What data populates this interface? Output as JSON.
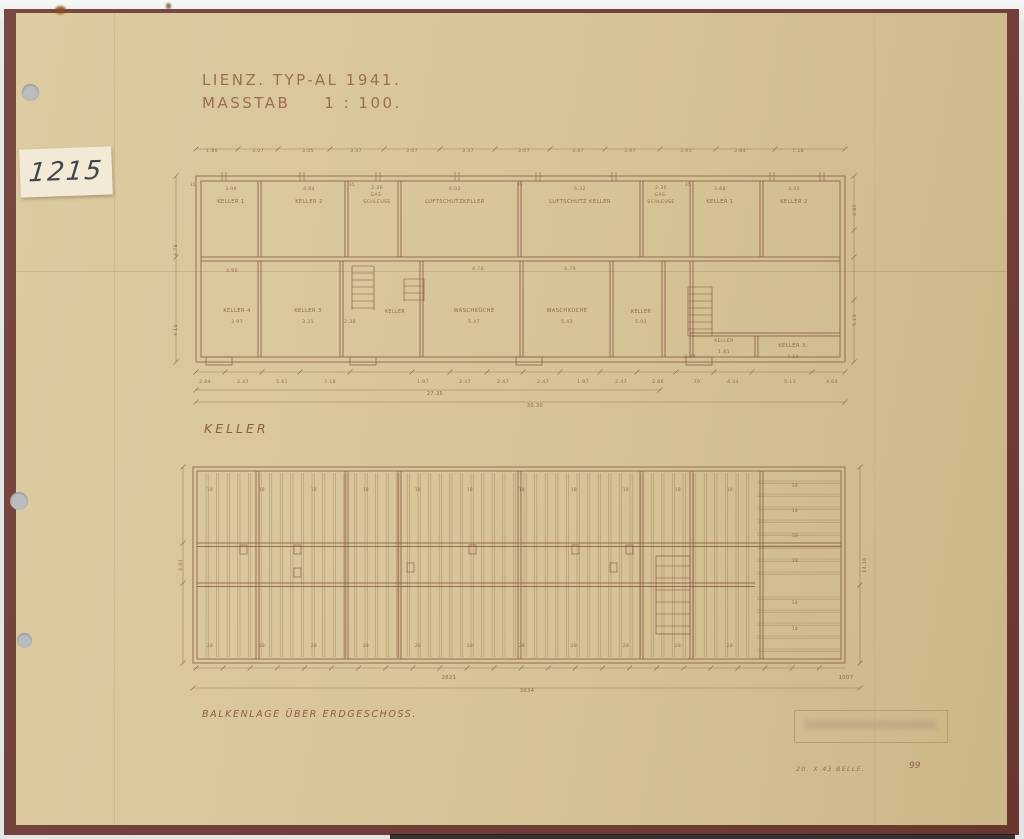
{
  "sheet": {
    "inventory_number": "1215",
    "title_line1": "LIENZ. TYP-AL 1941.",
    "scale_label": "MASSTAB",
    "scale_value": "1 : 100.",
    "plan1_caption": "KELLER",
    "plan2_caption": "BALKENLAGE ÜBER ERDGESCHOSS.",
    "footer_note": "20. X 43 BELLE.",
    "footer_number": "99"
  },
  "colors": {
    "paper": "#d7c498",
    "frame": "#74413c",
    "ink": "#8a5f49",
    "ink_light": "#a27b5e"
  },
  "drawing": {
    "texts": [
      {
        "x": 212,
        "y": 152,
        "t": "1.80"
      },
      {
        "x": 258,
        "y": 152,
        "t": "3.07"
      },
      {
        "x": 308,
        "y": 152,
        "t": "3.05"
      },
      {
        "x": 356,
        "y": 152,
        "t": "3.37"
      },
      {
        "x": 412,
        "y": 152,
        "t": "3.07"
      },
      {
        "x": 468,
        "y": 152,
        "t": "3.37"
      },
      {
        "x": 524,
        "y": 152,
        "t": "3.07"
      },
      {
        "x": 578,
        "y": 152,
        "t": "3.47"
      },
      {
        "x": 630,
        "y": 152,
        "t": "3.07"
      },
      {
        "x": 686,
        "y": 152,
        "t": "3.01"
      },
      {
        "x": 740,
        "y": 152,
        "t": "3.84"
      },
      {
        "x": 798,
        "y": 152,
        "t": "7.18"
      },
      {
        "x": 193,
        "y": 186,
        "t": "35",
        "s": 4
      },
      {
        "x": 352,
        "y": 186,
        "t": "35",
        "s": 4
      },
      {
        "x": 520,
        "y": 186,
        "t": "35",
        "s": 4
      },
      {
        "x": 688,
        "y": 186,
        "t": "35",
        "s": 4
      },
      {
        "x": 231,
        "y": 190,
        "t": "3.90"
      },
      {
        "x": 309,
        "y": 190,
        "t": "4.84"
      },
      {
        "x": 377,
        "y": 189,
        "t": "2.30"
      },
      {
        "x": 455,
        "y": 190,
        "t": "6.02"
      },
      {
        "x": 580,
        "y": 190,
        "t": "6.32"
      },
      {
        "x": 661,
        "y": 189,
        "t": "2.30"
      },
      {
        "x": 720,
        "y": 190,
        "t": "3.68"
      },
      {
        "x": 794,
        "y": 190,
        "t": "3.45"
      },
      {
        "x": 231,
        "y": 203,
        "t": "KELLER 1",
        "s": 5.2
      },
      {
        "x": 309,
        "y": 203,
        "t": "KELLER 2",
        "s": 5.2
      },
      {
        "x": 377,
        "y": 196,
        "t": "GAS-",
        "s": 4.6
      },
      {
        "x": 377,
        "y": 203,
        "t": "SCHLEUSE",
        "s": 4.6
      },
      {
        "x": 455,
        "y": 203,
        "t": "LUFTSCHUTZKELLER",
        "s": 5.2
      },
      {
        "x": 580,
        "y": 203,
        "t": "LUFTSCHUTZ KELLER",
        "s": 5.2
      },
      {
        "x": 661,
        "y": 196,
        "t": "GAS-",
        "s": 4.6
      },
      {
        "x": 661,
        "y": 203,
        "t": "SCHLEUSE",
        "s": 4.6
      },
      {
        "x": 720,
        "y": 203,
        "t": "KELLER 1",
        "s": 5.2
      },
      {
        "x": 794,
        "y": 203,
        "t": "KELLER 2",
        "s": 5.2
      },
      {
        "x": 232,
        "y": 272,
        "t": "4.90"
      },
      {
        "x": 478,
        "y": 270,
        "t": "4.70"
      },
      {
        "x": 570,
        "y": 270,
        "t": "4.70"
      },
      {
        "x": 237,
        "y": 312,
        "t": "KELLER 4",
        "s": 5.2
      },
      {
        "x": 308,
        "y": 312,
        "t": "KELLER 3",
        "s": 5.2
      },
      {
        "x": 395,
        "y": 313,
        "t": "KELLER",
        "s": 4.8
      },
      {
        "x": 474,
        "y": 312,
        "t": "WASCHKÜCHE",
        "s": 5.2
      },
      {
        "x": 567,
        "y": 312,
        "t": "WASCHKÜCHE",
        "s": 5.2
      },
      {
        "x": 641,
        "y": 313,
        "t": "KELLER",
        "s": 4.8
      },
      {
        "x": 237,
        "y": 323,
        "t": "3.97"
      },
      {
        "x": 308,
        "y": 323,
        "t": "3.31"
      },
      {
        "x": 350,
        "y": 323,
        "t": "2.38"
      },
      {
        "x": 474,
        "y": 323,
        "t": "5.47"
      },
      {
        "x": 567,
        "y": 323,
        "t": "5.43"
      },
      {
        "x": 641,
        "y": 323,
        "t": "5.03"
      },
      {
        "x": 724,
        "y": 342,
        "t": "KELLER",
        "s": 4.6
      },
      {
        "x": 793,
        "y": 347,
        "t": "KELLER 3.",
        "s": 5.2
      },
      {
        "x": 690,
        "y": 358,
        "t": "2.97"
      },
      {
        "x": 724,
        "y": 353,
        "t": "1.81"
      },
      {
        "x": 793,
        "y": 358,
        "t": "4.19"
      },
      {
        "x": 205,
        "y": 383,
        "t": "2.84"
      },
      {
        "x": 243,
        "y": 383,
        "t": "2.47"
      },
      {
        "x": 282,
        "y": 383,
        "t": "5.61"
      },
      {
        "x": 330,
        "y": 383,
        "t": "7.18"
      },
      {
        "x": 423,
        "y": 383,
        "t": "1.97"
      },
      {
        "x": 465,
        "y": 383,
        "t": "2.47"
      },
      {
        "x": 503,
        "y": 383,
        "t": "2.47"
      },
      {
        "x": 543,
        "y": 383,
        "t": "2.47"
      },
      {
        "x": 583,
        "y": 383,
        "t": "1.97"
      },
      {
        "x": 621,
        "y": 383,
        "t": "2.47"
      },
      {
        "x": 658,
        "y": 383,
        "t": "2.86"
      },
      {
        "x": 696,
        "y": 383,
        "t": ".70"
      },
      {
        "x": 733,
        "y": 383,
        "t": "4.34"
      },
      {
        "x": 790,
        "y": 383,
        "t": "5.11"
      },
      {
        "x": 832,
        "y": 383,
        "t": "4.04"
      },
      {
        "x": 435,
        "y": 395,
        "t": "27.25",
        "s": 5
      },
      {
        "x": 535,
        "y": 407,
        "t": "30.30",
        "s": 5
      },
      {
        "x": 177,
        "y": 250,
        "t": "4.78",
        "r": -90
      },
      {
        "x": 177,
        "y": 330,
        "t": "4.10",
        "r": -90
      },
      {
        "x": 856,
        "y": 210,
        "t": "4.65",
        "r": -90
      },
      {
        "x": 856,
        "y": 320,
        "t": "5.11",
        "r": -90
      },
      {
        "x": 210,
        "y": 491,
        "t": "18",
        "s": 4.2
      },
      {
        "x": 262,
        "y": 491,
        "t": "18",
        "s": 4.2
      },
      {
        "x": 314,
        "y": 491,
        "t": "18",
        "s": 4.2
      },
      {
        "x": 366,
        "y": 491,
        "t": "18",
        "s": 4.2
      },
      {
        "x": 418,
        "y": 491,
        "t": "18",
        "s": 4.2
      },
      {
        "x": 470,
        "y": 491,
        "t": "18",
        "s": 4.2
      },
      {
        "x": 522,
        "y": 491,
        "t": "18",
        "s": 4.2
      },
      {
        "x": 574,
        "y": 491,
        "t": "18",
        "s": 4.2
      },
      {
        "x": 626,
        "y": 491,
        "t": "18",
        "s": 4.2
      },
      {
        "x": 678,
        "y": 491,
        "t": "18",
        "s": 4.2
      },
      {
        "x": 730,
        "y": 491,
        "t": "18",
        "s": 4.2
      },
      {
        "x": 210,
        "y": 647,
        "t": "28",
        "s": 4.2
      },
      {
        "x": 262,
        "y": 647,
        "t": "28",
        "s": 4.2
      },
      {
        "x": 314,
        "y": 647,
        "t": "28",
        "s": 4.2
      },
      {
        "x": 366,
        "y": 647,
        "t": "28",
        "s": 4.2
      },
      {
        "x": 418,
        "y": 647,
        "t": "28",
        "s": 4.2
      },
      {
        "x": 470,
        "y": 647,
        "t": "28",
        "s": 4.2
      },
      {
        "x": 522,
        "y": 647,
        "t": "28",
        "s": 4.2
      },
      {
        "x": 574,
        "y": 647,
        "t": "28",
        "s": 4.2
      },
      {
        "x": 626,
        "y": 647,
        "t": "28",
        "s": 4.2
      },
      {
        "x": 678,
        "y": 647,
        "t": "28",
        "s": 4.2
      },
      {
        "x": 730,
        "y": 647,
        "t": "28",
        "s": 4.2
      },
      {
        "x": 795,
        "y": 487,
        "t": "18",
        "s": 4.2
      },
      {
        "x": 795,
        "y": 512,
        "t": "18",
        "s": 4.2
      },
      {
        "x": 795,
        "y": 537,
        "t": "18",
        "s": 4.2
      },
      {
        "x": 795,
        "y": 562,
        "t": "18",
        "s": 4.2
      },
      {
        "x": 795,
        "y": 604,
        "t": "18",
        "s": 4.2
      },
      {
        "x": 795,
        "y": 630,
        "t": "18",
        "s": 4.2
      },
      {
        "x": 182,
        "y": 565,
        "t": "4.93",
        "r": -90
      },
      {
        "x": 866,
        "y": 565,
        "t": "14.16",
        "r": -90
      },
      {
        "x": 449,
        "y": 679,
        "t": "2821",
        "s": 5.2
      },
      {
        "x": 527,
        "y": 692,
        "t": "3034",
        "s": 5.2
      },
      {
        "x": 846,
        "y": 679,
        "t": "1007",
        "s": 5.2
      }
    ]
  }
}
